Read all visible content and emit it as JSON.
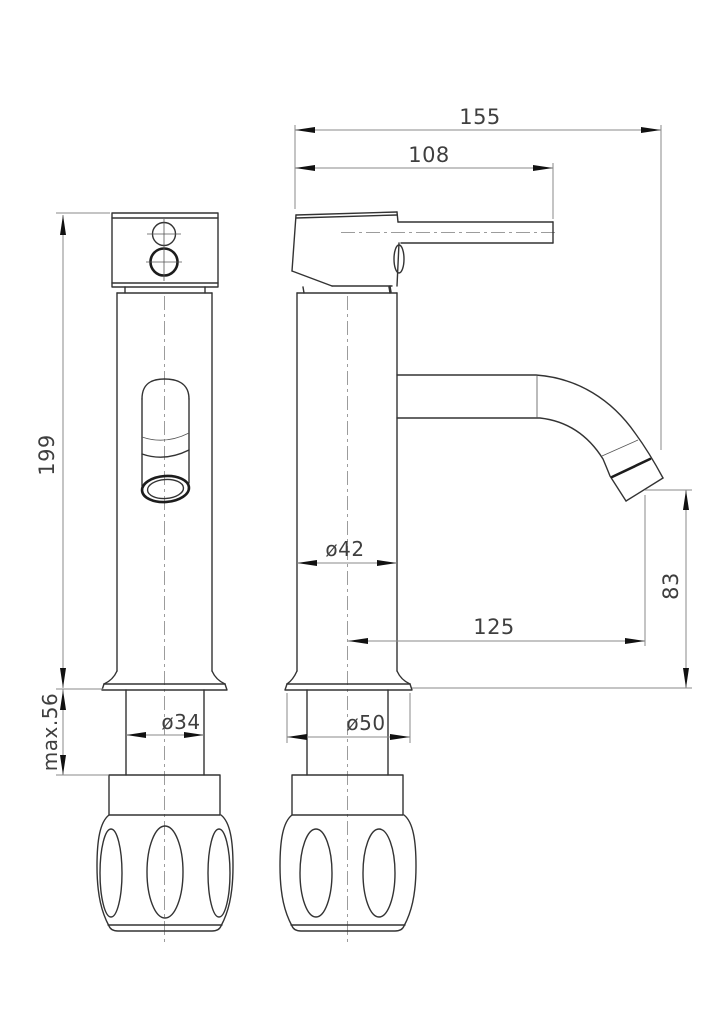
{
  "drawing": {
    "kind": "faucet-technical-drawing",
    "colors": {
      "background": "#ffffff",
      "outline": "#333333",
      "dimension_lines": "#8a8a8a",
      "centerlines": "#9c9c9c",
      "text": "#3f3f3f"
    },
    "dimensions": {
      "total_reach": "155",
      "handle_reach": "108",
      "body_height": "199",
      "max_deck_thickness": "max.56",
      "shank_diameter": "ø34",
      "body_diameter": "ø42",
      "base_diameter": "ø50",
      "spout_reach": "125",
      "spout_height": "83"
    }
  }
}
